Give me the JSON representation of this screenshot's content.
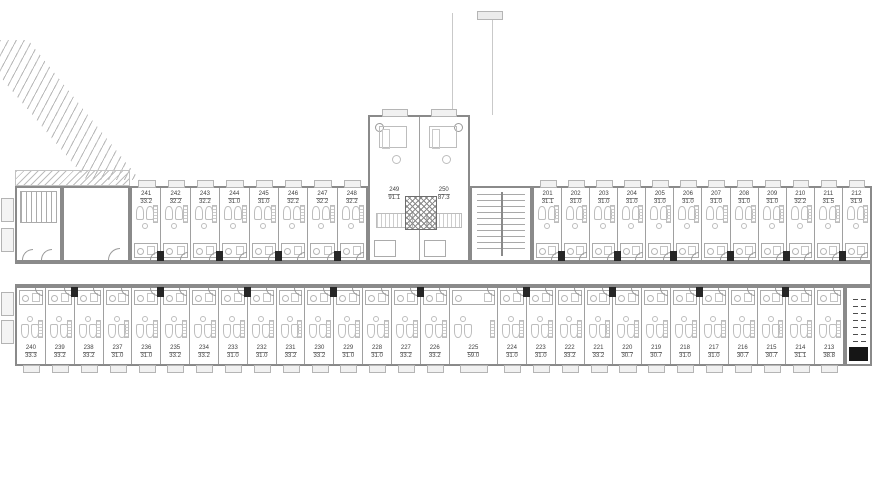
{
  "plan": {
    "type": "residential-floor-plan",
    "colors": {
      "wall": "#8a8a8a",
      "divider": "#a0a0a0",
      "furniture": "#bdbdbd",
      "shaft": "#262626",
      "label": "#3f3f3f"
    },
    "wings": {
      "top_left": {
        "units": [
          {
            "number": "241",
            "area": "33.2"
          },
          {
            "number": "242",
            "area": "32.2"
          },
          {
            "number": "243",
            "area": "32.2"
          },
          {
            "number": "244",
            "area": "31.0"
          },
          {
            "number": "245",
            "area": "31.0"
          },
          {
            "number": "246",
            "area": "32.2"
          },
          {
            "number": "247",
            "area": "32.2"
          },
          {
            "number": "248",
            "area": "32.2"
          }
        ]
      },
      "center": {
        "units": [
          {
            "number": "249",
            "area": "91.1"
          },
          {
            "number": "250",
            "area": "87.3"
          }
        ]
      },
      "top_right": {
        "units": [
          {
            "number": "201",
            "area": "31.1"
          },
          {
            "number": "202",
            "area": "31.0"
          },
          {
            "number": "203",
            "area": "31.0"
          },
          {
            "number": "204",
            "area": "31.0"
          },
          {
            "number": "205",
            "area": "31.0"
          },
          {
            "number": "206",
            "area": "31.0"
          },
          {
            "number": "207",
            "area": "31.0"
          },
          {
            "number": "208",
            "area": "31.0"
          },
          {
            "number": "209",
            "area": "31.0"
          },
          {
            "number": "210",
            "area": "32.2"
          },
          {
            "number": "211",
            "area": "31.5"
          },
          {
            "number": "212",
            "area": "31.9"
          }
        ]
      },
      "bottom": {
        "units": [
          {
            "number": "240",
            "area": "33.3"
          },
          {
            "number": "239",
            "area": "33.2"
          },
          {
            "number": "238",
            "area": "33.2"
          },
          {
            "number": "237",
            "area": "31.0"
          },
          {
            "number": "236",
            "area": "31.0"
          },
          {
            "number": "235",
            "area": "33.2"
          },
          {
            "number": "234",
            "area": "33.2"
          },
          {
            "number": "233",
            "area": "31.0"
          },
          {
            "number": "232",
            "area": "31.0"
          },
          {
            "number": "231",
            "area": "33.2"
          },
          {
            "number": "230",
            "area": "33.2"
          },
          {
            "number": "229",
            "area": "31.0"
          },
          {
            "number": "228",
            "area": "31.0"
          },
          {
            "number": "227",
            "area": "33.2"
          },
          {
            "number": "226",
            "area": "33.2"
          },
          {
            "number": "225",
            "area": "59.0",
            "flex": 1.7
          },
          {
            "number": "224",
            "area": "31.0"
          },
          {
            "number": "223",
            "area": "31.0"
          },
          {
            "number": "222",
            "area": "33.2"
          },
          {
            "number": "221",
            "area": "33.2"
          },
          {
            "number": "220",
            "area": "30.7"
          },
          {
            "number": "219",
            "area": "30.7"
          },
          {
            "number": "218",
            "area": "31.0"
          },
          {
            "number": "217",
            "area": "31.0"
          },
          {
            "number": "216",
            "area": "30.7"
          },
          {
            "number": "215",
            "area": "30.7"
          },
          {
            "number": "214",
            "area": "31.1"
          },
          {
            "number": "213",
            "area": "38.8"
          }
        ]
      }
    }
  }
}
